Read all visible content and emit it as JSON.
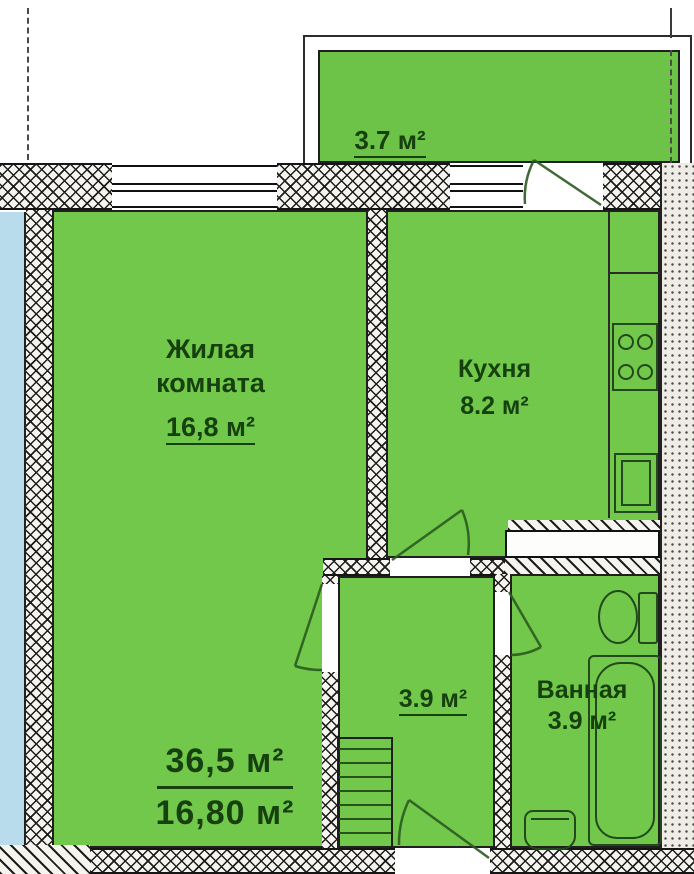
{
  "title": "Однокомнатная квартира — план",
  "colors": {
    "room_fill": "#71c84a",
    "balcony_fill": "#6cc347",
    "neighbor_fill": "#b9dcec",
    "wall_dark": "#1d1d1d",
    "label_text": "#17400f"
  },
  "rooms": {
    "balcony": {
      "area_label": "3.7 м²"
    },
    "living": {
      "name_line1": "Жилая",
      "name_line2": "комната",
      "area_label": "16,8 м²"
    },
    "kitchen": {
      "name": "Кухня",
      "area_label": "8.2 м²"
    },
    "hallway": {
      "area_label": "3.9 м²"
    },
    "bathroom": {
      "name": "Ванная",
      "area_label": "3.9 м²"
    }
  },
  "totals": {
    "total_area": "36,5 м²",
    "living_area": "16,80 м²"
  }
}
